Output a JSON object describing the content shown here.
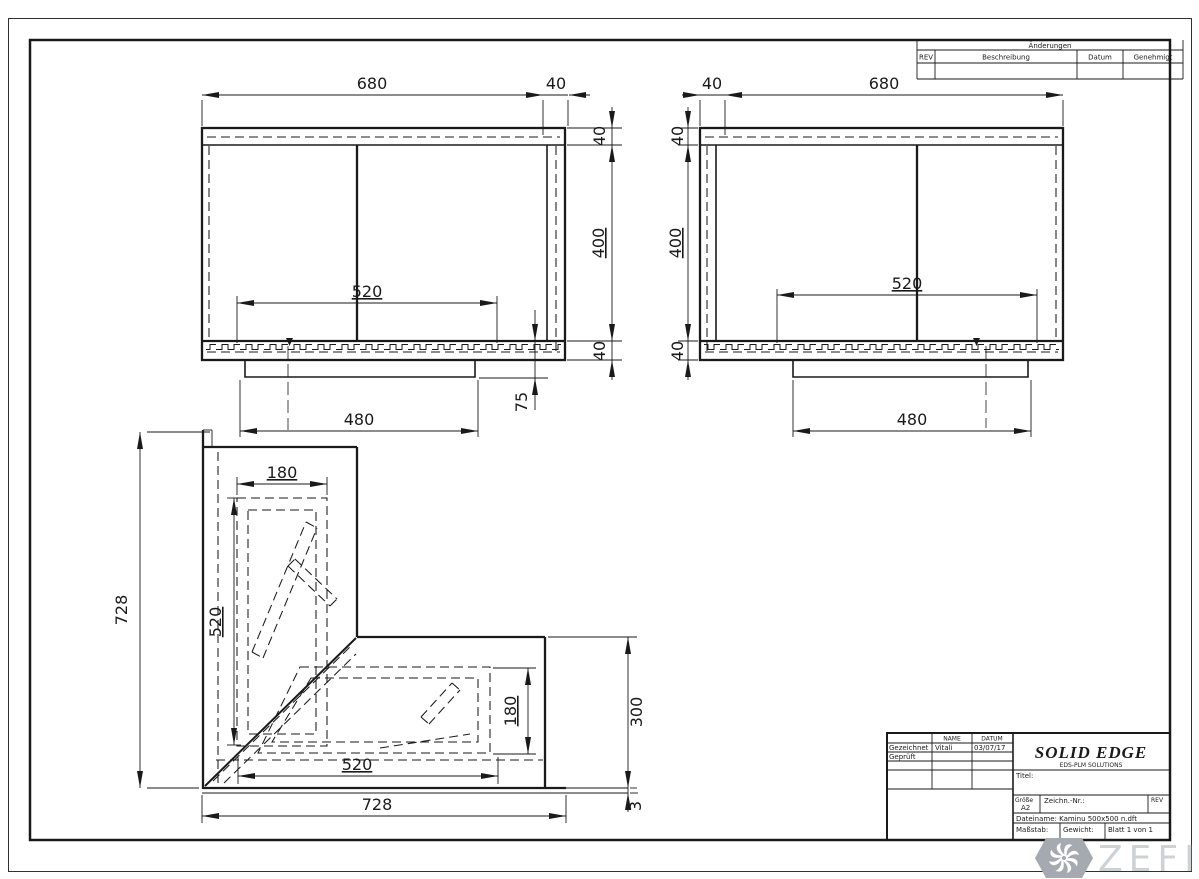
{
  "revision_table": {
    "title": "Änderungen",
    "col_rev": "REV",
    "col_desc": "Beschreibung",
    "col_date": "Datum",
    "col_approved": "Genehmigt"
  },
  "dims": {
    "front_left": {
      "top_width": "680",
      "top_side": "40",
      "side_top": "40",
      "side_mid": "400",
      "side_bottom": "40",
      "opening_width": "520",
      "pedestal_width": "480",
      "pedestal_offset": "75"
    },
    "front_right": {
      "top_side": "40",
      "top_width": "680",
      "side_top": "40",
      "side_mid": "400",
      "side_bottom": "40",
      "opening_width": "520",
      "pedestal_width": "480"
    },
    "corner": {
      "wall_height": "728",
      "recess_width": "180",
      "recess_height": "520",
      "floor_recess_depth": "180",
      "floor_opening_width": "520",
      "base_width": "728",
      "floor_depth": "300",
      "base_plate": "3"
    }
  },
  "title_block": {
    "name_header": "NAME",
    "date_header": "DATUM",
    "drawn_label": "Gezeichnet",
    "drawn_name": "Vitali",
    "drawn_date": "03/07/17",
    "checked_label": "Geprüft",
    "logo": "SOLID EDGE",
    "logo_sub": "EDS-PLM SOLUTIONS",
    "title_label": "Titel:",
    "size_label": "Größe",
    "size_value": "A2",
    "drawing_no_label": "Zeichn.-Nr.:",
    "rev_label": "REV",
    "filename": "Dateiname: Kaminu 500x500 n.dft",
    "scale_label": "Maßstab:",
    "weight_label": "Gewicht:",
    "sheet_label": "Blatt 1 von 1"
  },
  "watermark": {
    "brand": "ZEFIRE"
  }
}
